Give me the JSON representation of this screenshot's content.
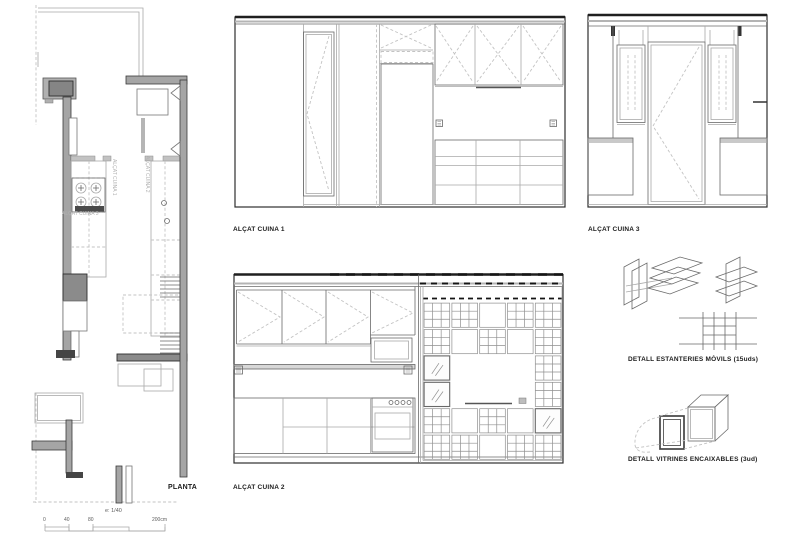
{
  "sheet": {
    "background": "#ffffff"
  },
  "colors": {
    "line": "#6a6a6a",
    "line_dark": "#1f1f1f",
    "wall_fill": "#a5a5a5",
    "appliance_fill": "#8b8b8b",
    "dashed_line": "#c3c3c3",
    "label_text": "#1b1b1b",
    "annotation_text": "#b3b3b3"
  },
  "plan": {
    "label": "PLANTA",
    "scale_note": "e: 1/40",
    "scale_ticks": [
      "0",
      "40",
      "80",
      "200cm"
    ],
    "annotations": {
      "cuina1": "ALÇAT CUINA 1",
      "cuina2": "ALÇAT CUINA 2",
      "cuina3": "ALÇAT CUINA 3"
    }
  },
  "elevations": {
    "cuina1": {
      "label": "ALÇAT CUINA 1"
    },
    "cuina2": {
      "label": "ALÇAT CUINA 2"
    },
    "cuina3": {
      "label": "ALÇAT CUINA 3"
    }
  },
  "details": {
    "estanteries": {
      "label": "DETALL ESTANTERIES MÒVILS (15uds)"
    },
    "vitrines": {
      "label": "DETALL VITRINES ENCAIXABLES (3ud)"
    }
  },
  "shelf_wall": {
    "legend": {
      "g": "grid-shelf-module",
      "b": "blank-panel-module",
      "v": "glass-vitrine-module",
      "o": "open-bay"
    },
    "rows": [
      [
        "g",
        "g",
        "b",
        "g",
        "g"
      ],
      [
        "g",
        "b",
        "g",
        "b",
        "g"
      ],
      [
        "v",
        "o",
        "o",
        "o",
        "g"
      ],
      [
        "v",
        "o",
        "o",
        "o",
        "g"
      ],
      [
        "g",
        "b",
        "g",
        "b",
        "v"
      ],
      [
        "g",
        "g",
        "b",
        "g",
        "g"
      ]
    ]
  }
}
